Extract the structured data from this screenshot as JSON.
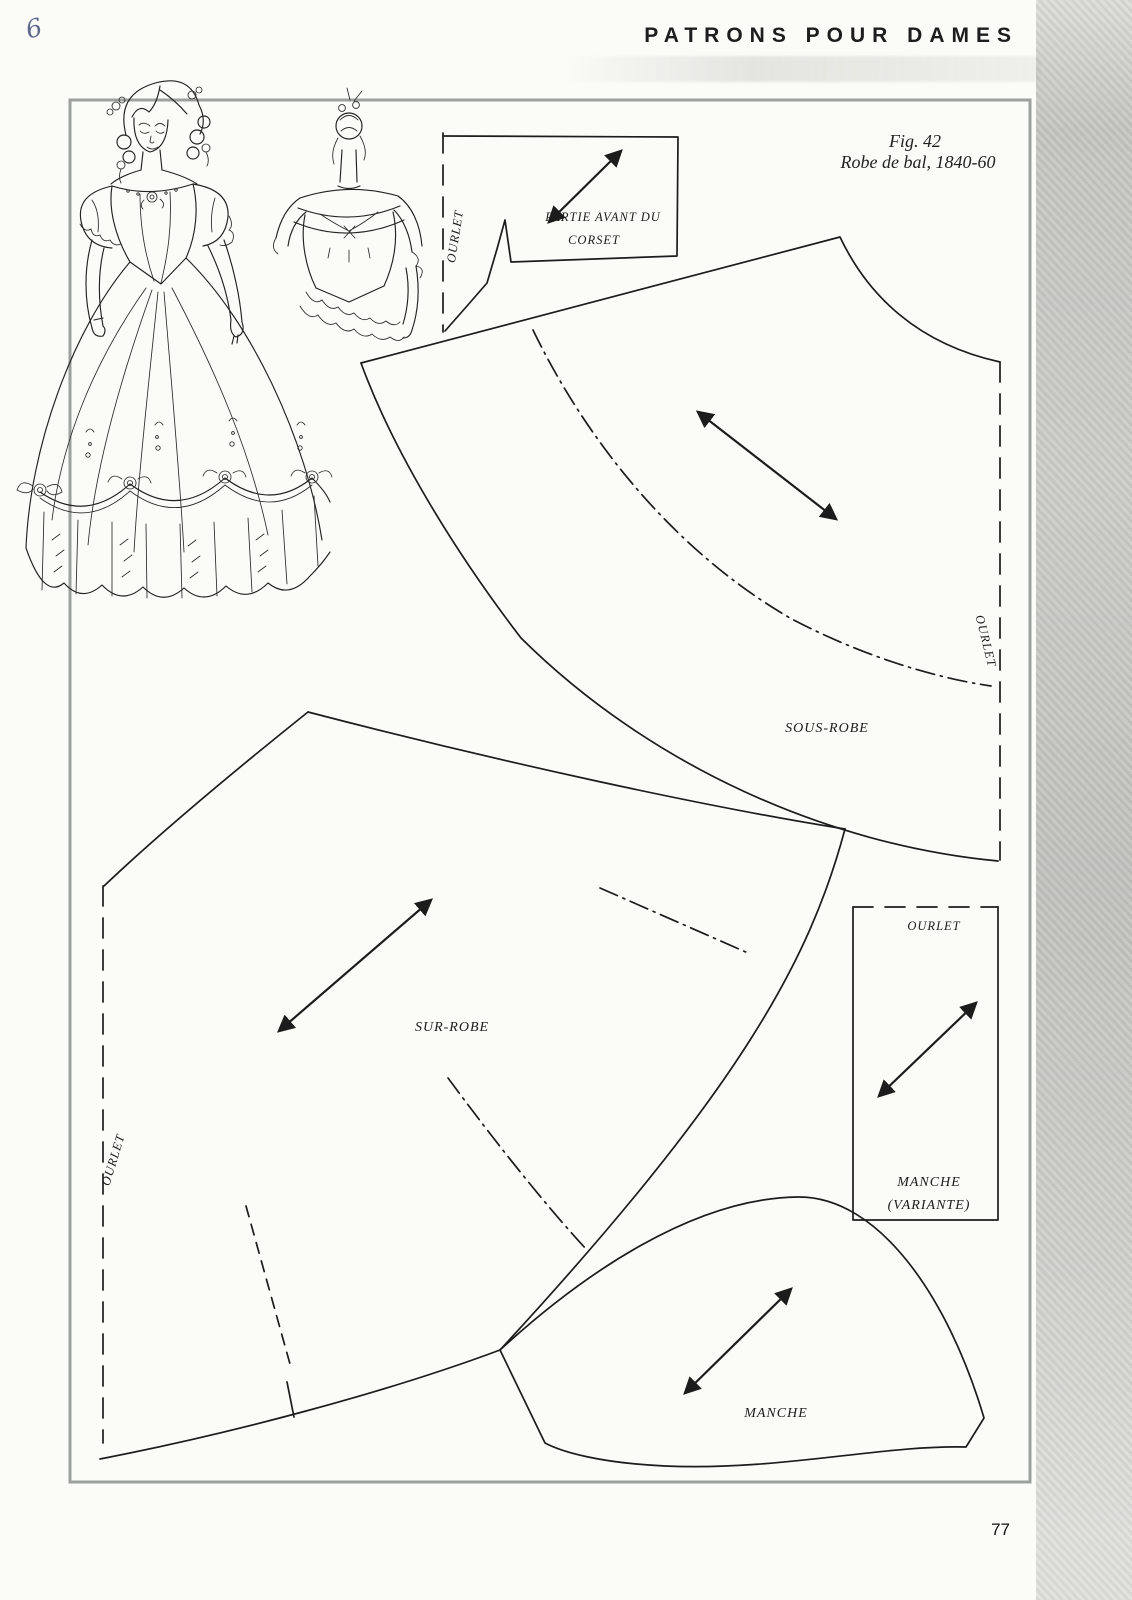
{
  "page": {
    "header": "PATRONS POUR DAMES",
    "handwritten_mark": "6",
    "figure_caption": {
      "line1": "Fig. 42",
      "line2": "Robe de bal, 1840-60"
    },
    "page_number": "77"
  },
  "labels": {
    "corset": {
      "name_line1": "PARTIE AVANT DU",
      "name_line2": "CORSET",
      "fold": "OURLET"
    },
    "sous_robe": {
      "name": "SOUS-ROBE",
      "hem": "OURLET"
    },
    "sur_robe": {
      "name": "SUR-ROBE",
      "hem": "OURLET"
    },
    "manche_variante": {
      "name_line1": "MANCHE",
      "name_line2": "(VARIANTE)",
      "hem": "OURLET"
    },
    "manche": {
      "name": "MANCHE"
    }
  },
  "colors": {
    "paper": "#fbfbf7",
    "ink": "#1c1c1c",
    "frame": "#9da09d",
    "scan_band": "#bfbfbc",
    "handwriting": "#44507a"
  }
}
